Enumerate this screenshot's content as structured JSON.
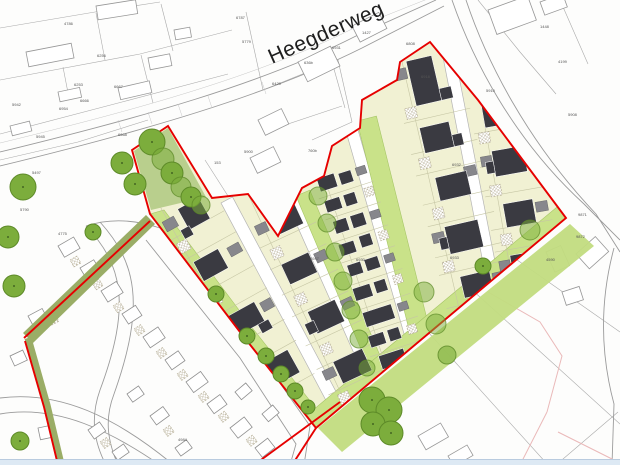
{
  "map": {
    "street_label": "Heegderweg",
    "parcel_labels": [
      {
        "x": 64,
        "y": 25,
        "text": "4786"
      },
      {
        "x": 97,
        "y": 57,
        "text": "6256"
      },
      {
        "x": 74,
        "y": 86,
        "text": "6253"
      },
      {
        "x": 12,
        "y": 106,
        "text": "5942"
      },
      {
        "x": 59,
        "y": 110,
        "text": "6954"
      },
      {
        "x": 36,
        "y": 138,
        "text": "5945"
      },
      {
        "x": 80,
        "y": 102,
        "text": "6666"
      },
      {
        "x": 114,
        "y": 88,
        "text": "6667"
      },
      {
        "x": 118,
        "y": 136,
        "text": "6668"
      },
      {
        "x": 236,
        "y": 19,
        "text": "6787"
      },
      {
        "x": 242,
        "y": 43,
        "text": "5779"
      },
      {
        "x": 332,
        "y": 49,
        "text": "6931"
      },
      {
        "x": 304,
        "y": 64,
        "text": "636b"
      },
      {
        "x": 362,
        "y": 34,
        "text": "1427"
      },
      {
        "x": 406,
        "y": 45,
        "text": "6808"
      },
      {
        "x": 272,
        "y": 85,
        "text": "6429"
      },
      {
        "x": 244,
        "y": 153,
        "text": "5900"
      },
      {
        "x": 214,
        "y": 164,
        "text": "153"
      },
      {
        "x": 308,
        "y": 152,
        "text": "760b"
      },
      {
        "x": 32,
        "y": 174,
        "text": "5497"
      },
      {
        "x": 20,
        "y": 211,
        "text": "5790"
      },
      {
        "x": 58,
        "y": 235,
        "text": "4775"
      },
      {
        "x": 558,
        "y": 63,
        "text": "4199"
      },
      {
        "x": 486,
        "y": 92,
        "text": "5910"
      },
      {
        "x": 568,
        "y": 116,
        "text": "5908"
      },
      {
        "x": 578,
        "y": 216,
        "text": "9871"
      },
      {
        "x": 576,
        "y": 238,
        "text": "9872"
      },
      {
        "x": 546,
        "y": 261,
        "text": "4590"
      },
      {
        "x": 310,
        "y": 260,
        "text": "6947"
      },
      {
        "x": 452,
        "y": 166,
        "text": "6932"
      },
      {
        "x": 450,
        "y": 259,
        "text": "6933"
      },
      {
        "x": 356,
        "y": 261,
        "text": "6930"
      },
      {
        "x": 421,
        "y": 78,
        "text": "6918"
      },
      {
        "x": 178,
        "y": 441,
        "text": "4984"
      },
      {
        "x": 540,
        "y": 28,
        "text": "1448"
      }
    ],
    "colors": {
      "site_boundary": "#e60000",
      "parcel_fill": "#f1f1d3",
      "building": "#3a3a41",
      "outbuilding": "#87878c",
      "green_verge": "#c9e289",
      "green_buffer": "#9aad66",
      "tree": "#7cad3c",
      "tree_outline": "#5d8a28",
      "context_line": "#aaaaaa",
      "road_fill": "#ffffff",
      "footer_bar": "#dde9f4"
    }
  }
}
